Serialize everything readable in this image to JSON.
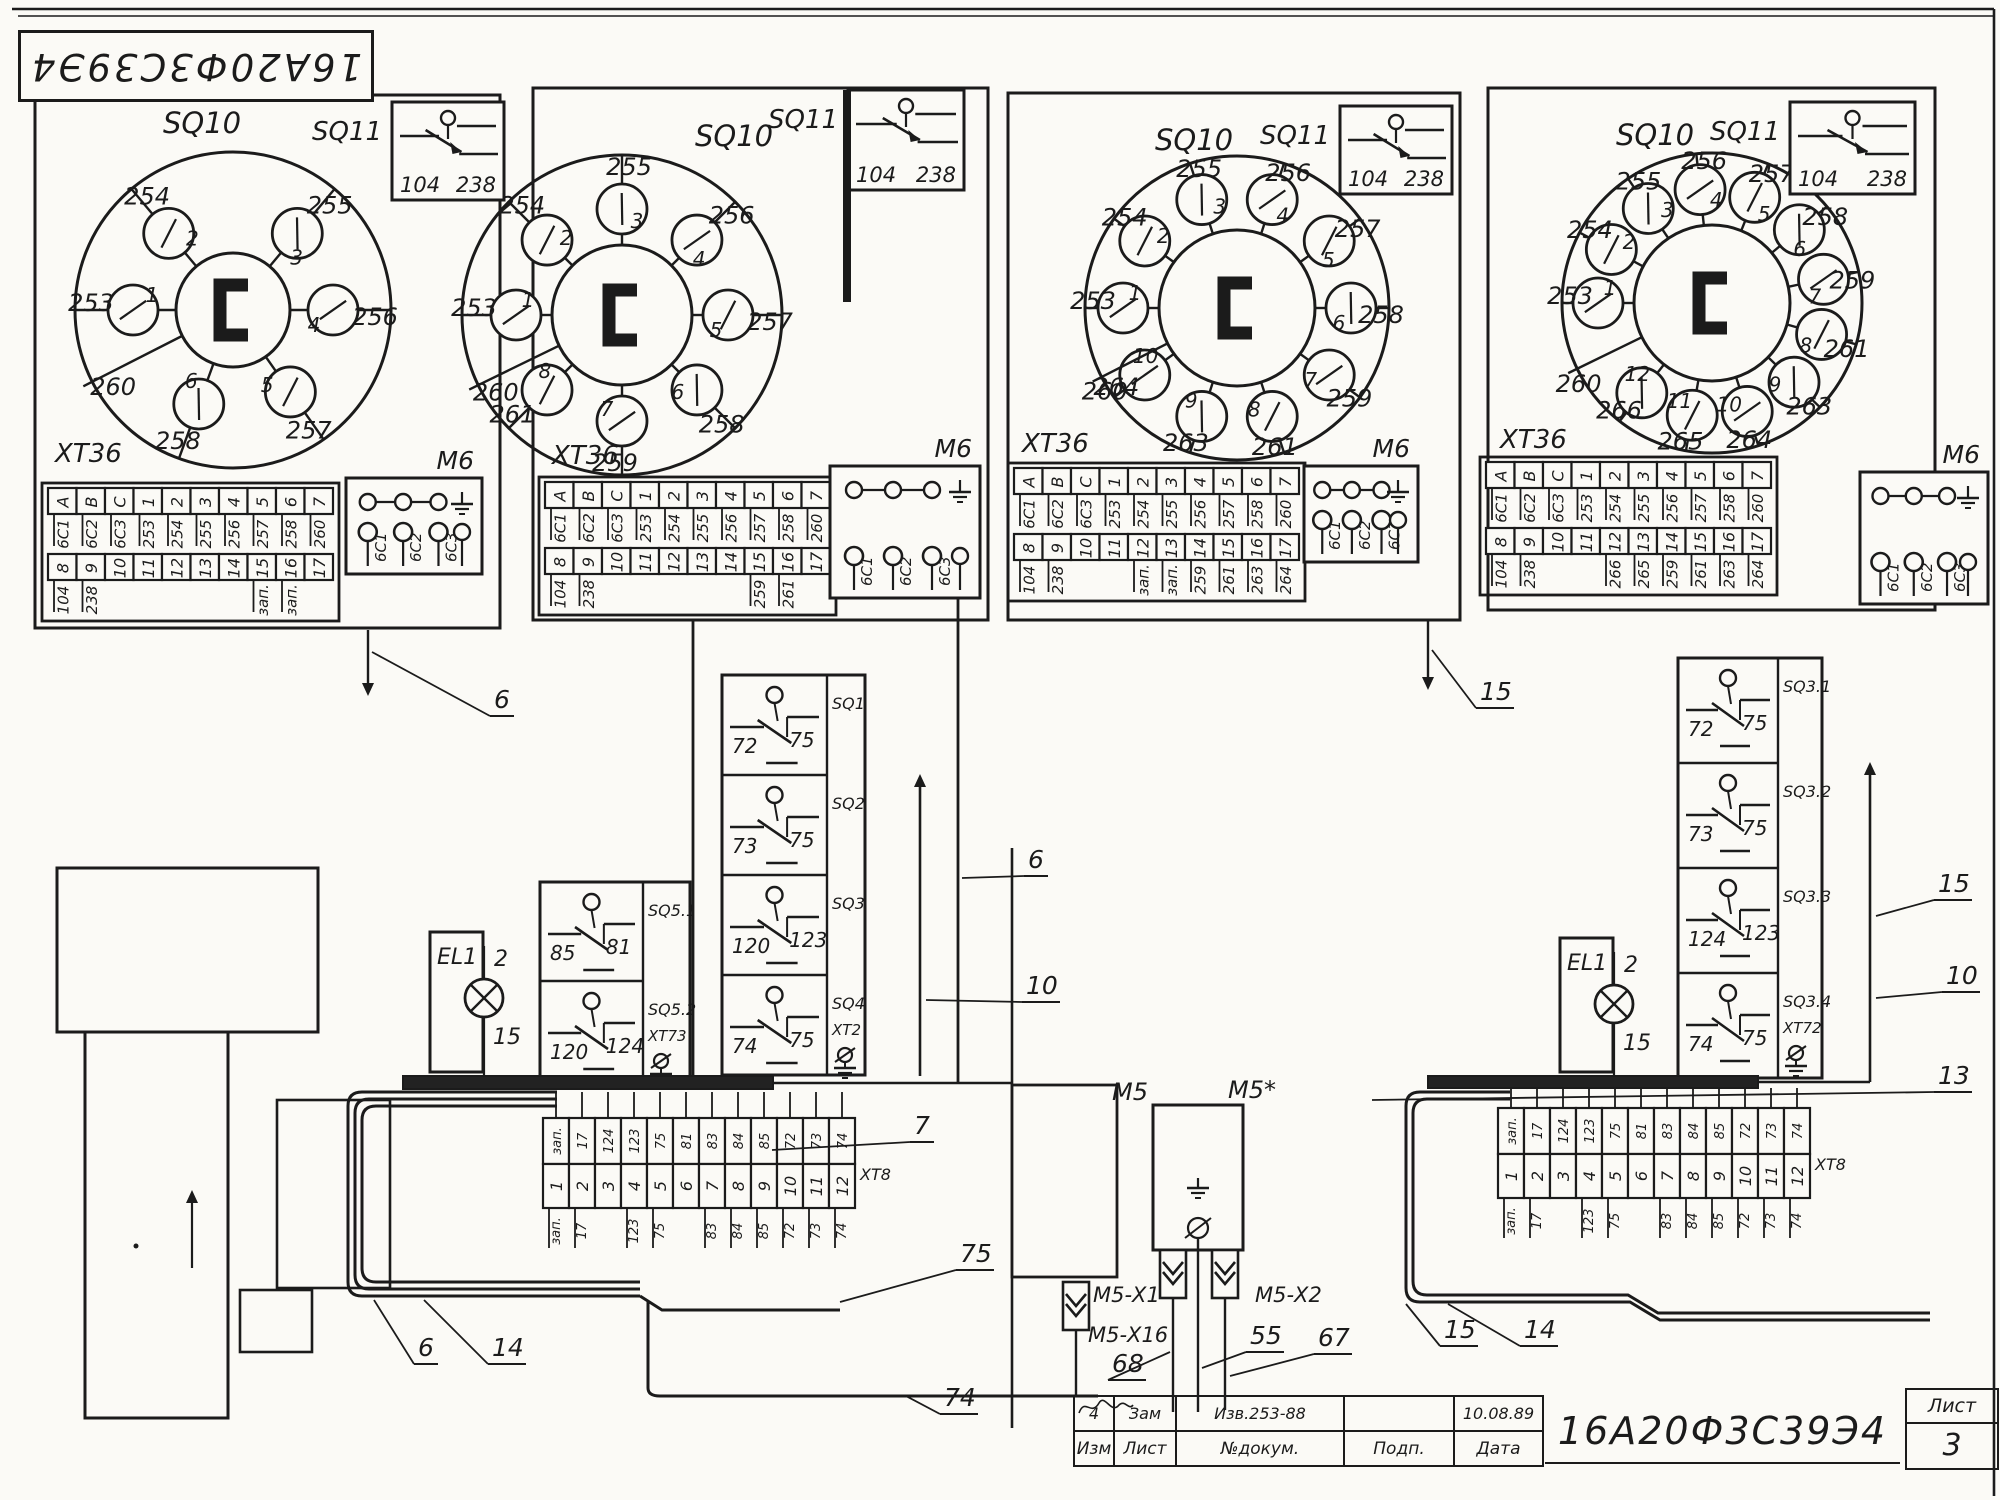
{
  "sheet": {
    "flipped_code": "16А20Ф3С39Э4"
  },
  "title_block": {
    "code": "16А20Ф3С39Э4",
    "revision_row": [
      "4",
      "Зам",
      "Изв.253-88",
      "",
      "10.08.89"
    ],
    "header_row": [
      "Изм",
      "Лист",
      "№докум.",
      "Подп.",
      "Дата"
    ],
    "sheet_label": "Лист",
    "sheet_number": "3"
  },
  "panels": [
    {
      "switch_label": "SQ10",
      "inset": {
        "label": "SQ11",
        "terminals": [
          "104",
          "238"
        ]
      },
      "common_wire": "260",
      "positions": [
        {
          "n": "1",
          "wire": "253"
        },
        {
          "n": "2",
          "wire": "254"
        },
        {
          "n": "3",
          "wire": "255"
        },
        {
          "n": "4",
          "wire": "256"
        },
        {
          "n": "5",
          "wire": "257"
        },
        {
          "n": "6",
          "wire": "258"
        }
      ],
      "xt": {
        "label": "ХТ36",
        "row1_heads": [
          "А",
          "В",
          "С",
          "1",
          "2",
          "3",
          "4",
          "5",
          "6",
          "7"
        ],
        "row1_vals": [
          "6С1",
          "6С2",
          "6С3",
          "253",
          "254",
          "255",
          "256",
          "257",
          "258",
          "260"
        ],
        "row2_heads": [
          "8",
          "9",
          "10",
          "11",
          "12",
          "13",
          "14",
          "15",
          "16",
          "17"
        ],
        "row2_vals": [
          "104",
          "238",
          "",
          "",
          "",
          "",
          "",
          "зап.",
          "зап.",
          ""
        ]
      },
      "motor": {
        "label": "М6",
        "terminals": [
          "6С1",
          "6С2",
          "6С3"
        ]
      }
    },
    {
      "switch_label": "SQ10",
      "inset": {
        "label": "SQ11",
        "terminals": [
          "104",
          "238"
        ]
      },
      "common_wire": "260",
      "positions": [
        {
          "n": "1",
          "wire": "253"
        },
        {
          "n": "2",
          "wire": "254"
        },
        {
          "n": "3",
          "wire": "255"
        },
        {
          "n": "4",
          "wire": "256"
        },
        {
          "n": "5",
          "wire": "257"
        },
        {
          "n": "6",
          "wire": "258"
        },
        {
          "n": "7",
          "wire": "259"
        },
        {
          "n": "8",
          "wire": "261"
        }
      ],
      "xt": {
        "label": "ХТ36",
        "row1_heads": [
          "А",
          "В",
          "С",
          "1",
          "2",
          "3",
          "4",
          "5",
          "6",
          "7"
        ],
        "row1_vals": [
          "6С1",
          "6С2",
          "6С3",
          "253",
          "254",
          "255",
          "256",
          "257",
          "258",
          "260"
        ],
        "row2_heads": [
          "8",
          "9",
          "10",
          "11",
          "12",
          "13",
          "14",
          "15",
          "16",
          "17"
        ],
        "row2_vals": [
          "104",
          "238",
          "",
          "",
          "",
          "",
          "",
          "259",
          "261",
          ""
        ]
      },
      "motor": {
        "label": "М6",
        "terminals": [
          "6С1",
          "6С2",
          "6С3"
        ]
      }
    },
    {
      "switch_label": "SQ10",
      "inset": {
        "label": "SQ11",
        "terminals": [
          "104",
          "238"
        ]
      },
      "common_wire": "260",
      "positions": [
        {
          "n": "1",
          "wire": "253"
        },
        {
          "n": "2",
          "wire": "254"
        },
        {
          "n": "3",
          "wire": "255"
        },
        {
          "n": "4",
          "wire": "256"
        },
        {
          "n": "5",
          "wire": "257"
        },
        {
          "n": "6",
          "wire": "258"
        },
        {
          "n": "7",
          "wire": "259"
        },
        {
          "n": "8",
          "wire": "261"
        },
        {
          "n": "9",
          "wire": "263"
        },
        {
          "n": "10",
          "wire": "264"
        }
      ],
      "xt": {
        "label": "ХТ36",
        "row1_heads": [
          "А",
          "В",
          "С",
          "1",
          "2",
          "3",
          "4",
          "5",
          "6",
          "7"
        ],
        "row1_vals": [
          "6С1",
          "6С2",
          "6С3",
          "253",
          "254",
          "255",
          "256",
          "257",
          "258",
          "260"
        ],
        "row2_heads": [
          "8",
          "9",
          "10",
          "11",
          "12",
          "13",
          "14",
          "15",
          "16",
          "17"
        ],
        "row2_vals": [
          "104",
          "238",
          "",
          "",
          "зап.",
          "зап.",
          "259",
          "261",
          "263",
          "264"
        ]
      },
      "motor": {
        "label": "М6",
        "terminals": [
          "6С1",
          "6С2",
          "6С3"
        ]
      }
    },
    {
      "switch_label": "SQ10",
      "inset": {
        "label": "SQ11",
        "terminals": [
          "104",
          "238"
        ]
      },
      "common_wire": "260",
      "positions": [
        {
          "n": "1",
          "wire": "253"
        },
        {
          "n": "2",
          "wire": "254"
        },
        {
          "n": "3",
          "wire": "255"
        },
        {
          "n": "4",
          "wire": "256"
        },
        {
          "n": "5",
          "wire": "257"
        },
        {
          "n": "6",
          "wire": "258"
        },
        {
          "n": "7",
          "wire": "259"
        },
        {
          "n": "8",
          "wire": "261"
        },
        {
          "n": "9",
          "wire": "263"
        },
        {
          "n": "10",
          "wire": "264"
        },
        {
          "n": "11",
          "wire": "265"
        },
        {
          "n": "12",
          "wire": "266"
        }
      ],
      "xt": {
        "label": "ХТ36",
        "row1_heads": [
          "А",
          "В",
          "С",
          "1",
          "2",
          "3",
          "4",
          "5",
          "6",
          "7"
        ],
        "row1_vals": [
          "6С1",
          "6С2",
          "6С3",
          "253",
          "254",
          "255",
          "256",
          "257",
          "258",
          "260"
        ],
        "row2_heads": [
          "8",
          "9",
          "10",
          "11",
          "12",
          "13",
          "14",
          "15",
          "16",
          "17"
        ],
        "row2_vals": [
          "104",
          "238",
          "",
          "",
          "266",
          "265",
          "259",
          "261",
          "263",
          "264"
        ]
      },
      "motor": {
        "label": "М6",
        "terminals": [
          "6С1",
          "6С2",
          "6С3"
        ]
      }
    }
  ],
  "relay_columns": {
    "mid": [
      {
        "name": "SQ1",
        "a": "72",
        "b": "75"
      },
      {
        "name": "SQ2",
        "a": "73",
        "b": "75"
      },
      {
        "name": "SQ3",
        "a": "120",
        "b": "123"
      },
      {
        "name": "SQ4",
        "a": "74",
        "b": "75",
        "extra": "ХТ2",
        "ground": true
      }
    ],
    "right": [
      {
        "name": "SQ3.1",
        "a": "72",
        "b": "75"
      },
      {
        "name": "SQ3.2",
        "a": "73",
        "b": "75"
      },
      {
        "name": "SQ3.3",
        "a": "124",
        "b": "123"
      },
      {
        "name": "SQ3.4",
        "a": "74",
        "b": "75",
        "extra": "ХТ72",
        "ground": true
      }
    ],
    "sq5": [
      {
        "name": "SQ5.1",
        "a": "85",
        "b": "81"
      },
      {
        "name": "SQ5.2",
        "a": "120",
        "b": "124",
        "extra": "ХТ73",
        "ground": true
      }
    ]
  },
  "lamps": {
    "left": {
      "name": "EL1",
      "top": "2",
      "bottom": "15"
    },
    "right": {
      "name": "EL1",
      "top": "2",
      "bottom": "15"
    }
  },
  "strips": {
    "left": {
      "label": "ХТ8",
      "top": [
        "зап.",
        "17",
        "124",
        "123",
        "75",
        "81",
        "83",
        "84",
        "85",
        "72",
        "73",
        "74"
      ],
      "mid": [
        "1",
        "2",
        "3",
        "4",
        "5",
        "6",
        "7",
        "8",
        "9",
        "10",
        "11",
        "12"
      ],
      "bottom": [
        "зап.",
        "17",
        "",
        "123",
        "75",
        "",
        "83",
        "84",
        "85",
        "72",
        "73",
        "74"
      ]
    },
    "right": {
      "label": "ХТ8",
      "top": [
        "зап.",
        "17",
        "124",
        "123",
        "75",
        "81",
        "83",
        "84",
        "85",
        "72",
        "73",
        "74"
      ],
      "mid": [
        "1",
        "2",
        "3",
        "4",
        "5",
        "6",
        "7",
        "8",
        "9",
        "10",
        "11",
        "12"
      ],
      "bottom": [
        "зап.",
        "17",
        "",
        "123",
        "75",
        "",
        "83",
        "84",
        "85",
        "72",
        "73",
        "74"
      ]
    }
  },
  "m5": {
    "label": "М5",
    "label_star": "М5*",
    "conn_x1": "М5-Х1",
    "conn_x16": "М5-Х16",
    "conn_x2": "М5-Х2"
  },
  "wire_labels": {
    "w6a": "6",
    "w15a": "15",
    "w6b": "6",
    "w10a": "10",
    "w7": "7",
    "w75": "75",
    "w6c": "6",
    "w14a": "14",
    "w74": "74",
    "w68": "68",
    "w55": "55",
    "w67": "67",
    "w15b": "15",
    "w14b": "14",
    "w15c": "15",
    "w10b": "10",
    "w13": "13"
  }
}
